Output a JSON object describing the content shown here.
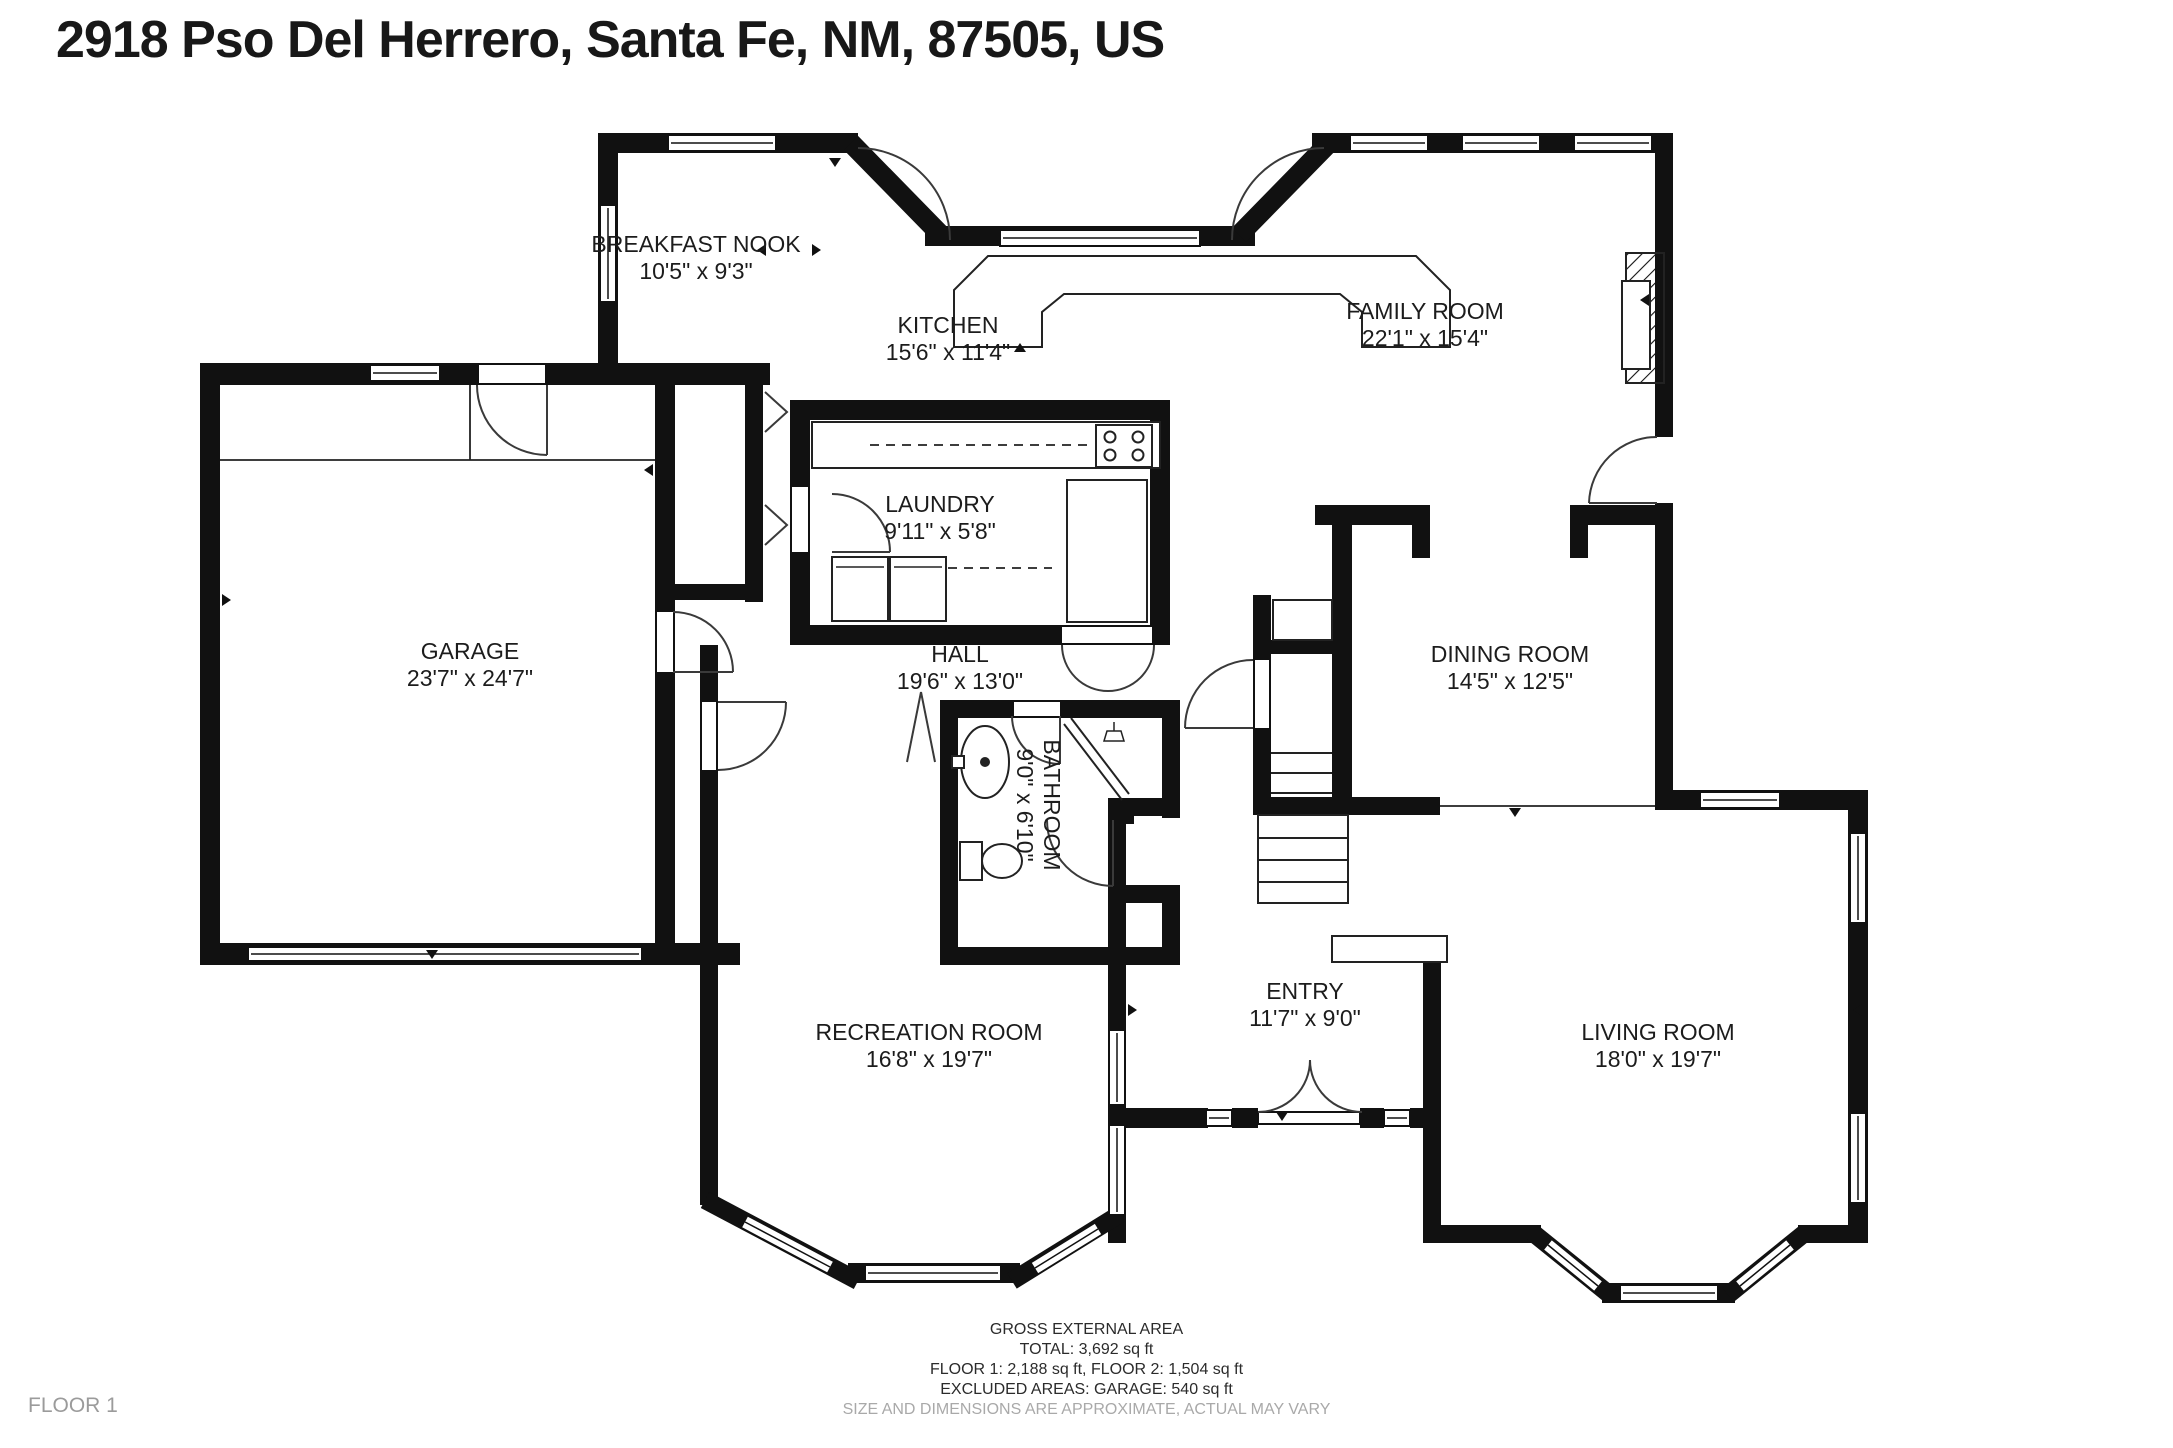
{
  "address": "2918 Pso Del Herrero, Santa Fe, NM, 87505, US",
  "floor_label": "FLOOR 1",
  "colors": {
    "wall": "#111111",
    "text": "#1c1c1c",
    "muted_gray": "#a9a9a9"
  },
  "rooms": [
    {
      "name": "BREAKFAST NOOK",
      "dims": "10'5\" x 9'3\""
    },
    {
      "name": "KITCHEN",
      "dims": "15'6\" x 11'4\""
    },
    {
      "name": "FAMILY ROOM",
      "dims": "22'1\" x 15'4\""
    },
    {
      "name": "GARAGE",
      "dims": "23'7\" x 24'7\""
    },
    {
      "name": "LAUNDRY",
      "dims": "9'11\" x 5'8\""
    },
    {
      "name": "HALL",
      "dims": "19'6\" x 13'0\""
    },
    {
      "name": "DINING ROOM",
      "dims": "14'5\" x 12'5\""
    },
    {
      "name": "BATHROOM",
      "dims": "9'0\" x 6'10\""
    },
    {
      "name": "RECREATION ROOM",
      "dims": "16'8\" x 19'7\""
    },
    {
      "name": "ENTRY",
      "dims": "11'7\" x 9'0\""
    },
    {
      "name": "LIVING ROOM",
      "dims": "18'0\" x 19'7\""
    }
  ],
  "footer": {
    "area_title": "GROSS EXTERNAL AREA",
    "total": "TOTAL: 3,692 sq ft",
    "floors": "FLOOR 1: 2,188 sq ft, FLOOR 2: 1,504 sq ft",
    "excluded": "EXCLUDED AREAS: GARAGE: 540 sq ft",
    "disclaimer": "SIZE AND DIMENSIONS ARE APPROXIMATE, ACTUAL MAY VARY"
  }
}
